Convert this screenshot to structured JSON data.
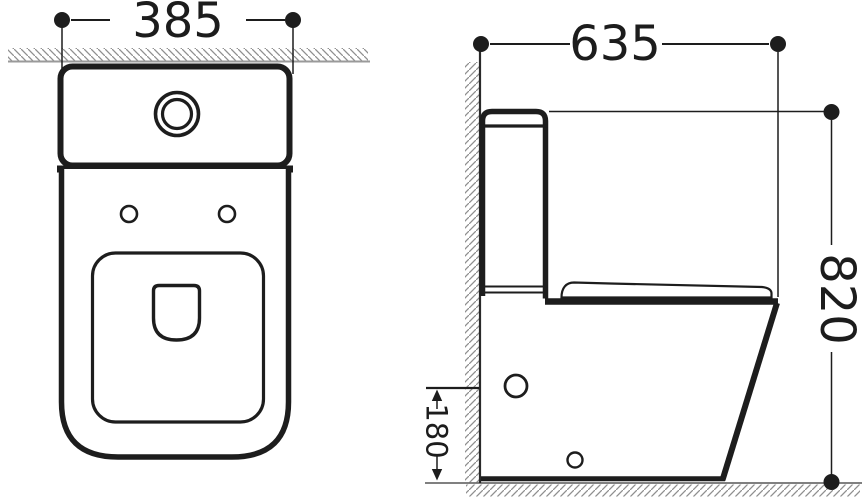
{
  "drawing": {
    "title": "two-view toilet technical drawing",
    "front_view": {
      "width_dim": "385"
    },
    "side_view": {
      "depth_dim": "635",
      "height_dim": "820",
      "outlet_height_dim": "180"
    },
    "colors": {
      "line": "#1d1d1d",
      "dim_text": "#1c1c1c",
      "hatch": "#8f8f8f",
      "front_wall_line": "#9a9a9a",
      "floor_line": "#6e6e6e",
      "background": "#ffffff"
    }
  }
}
